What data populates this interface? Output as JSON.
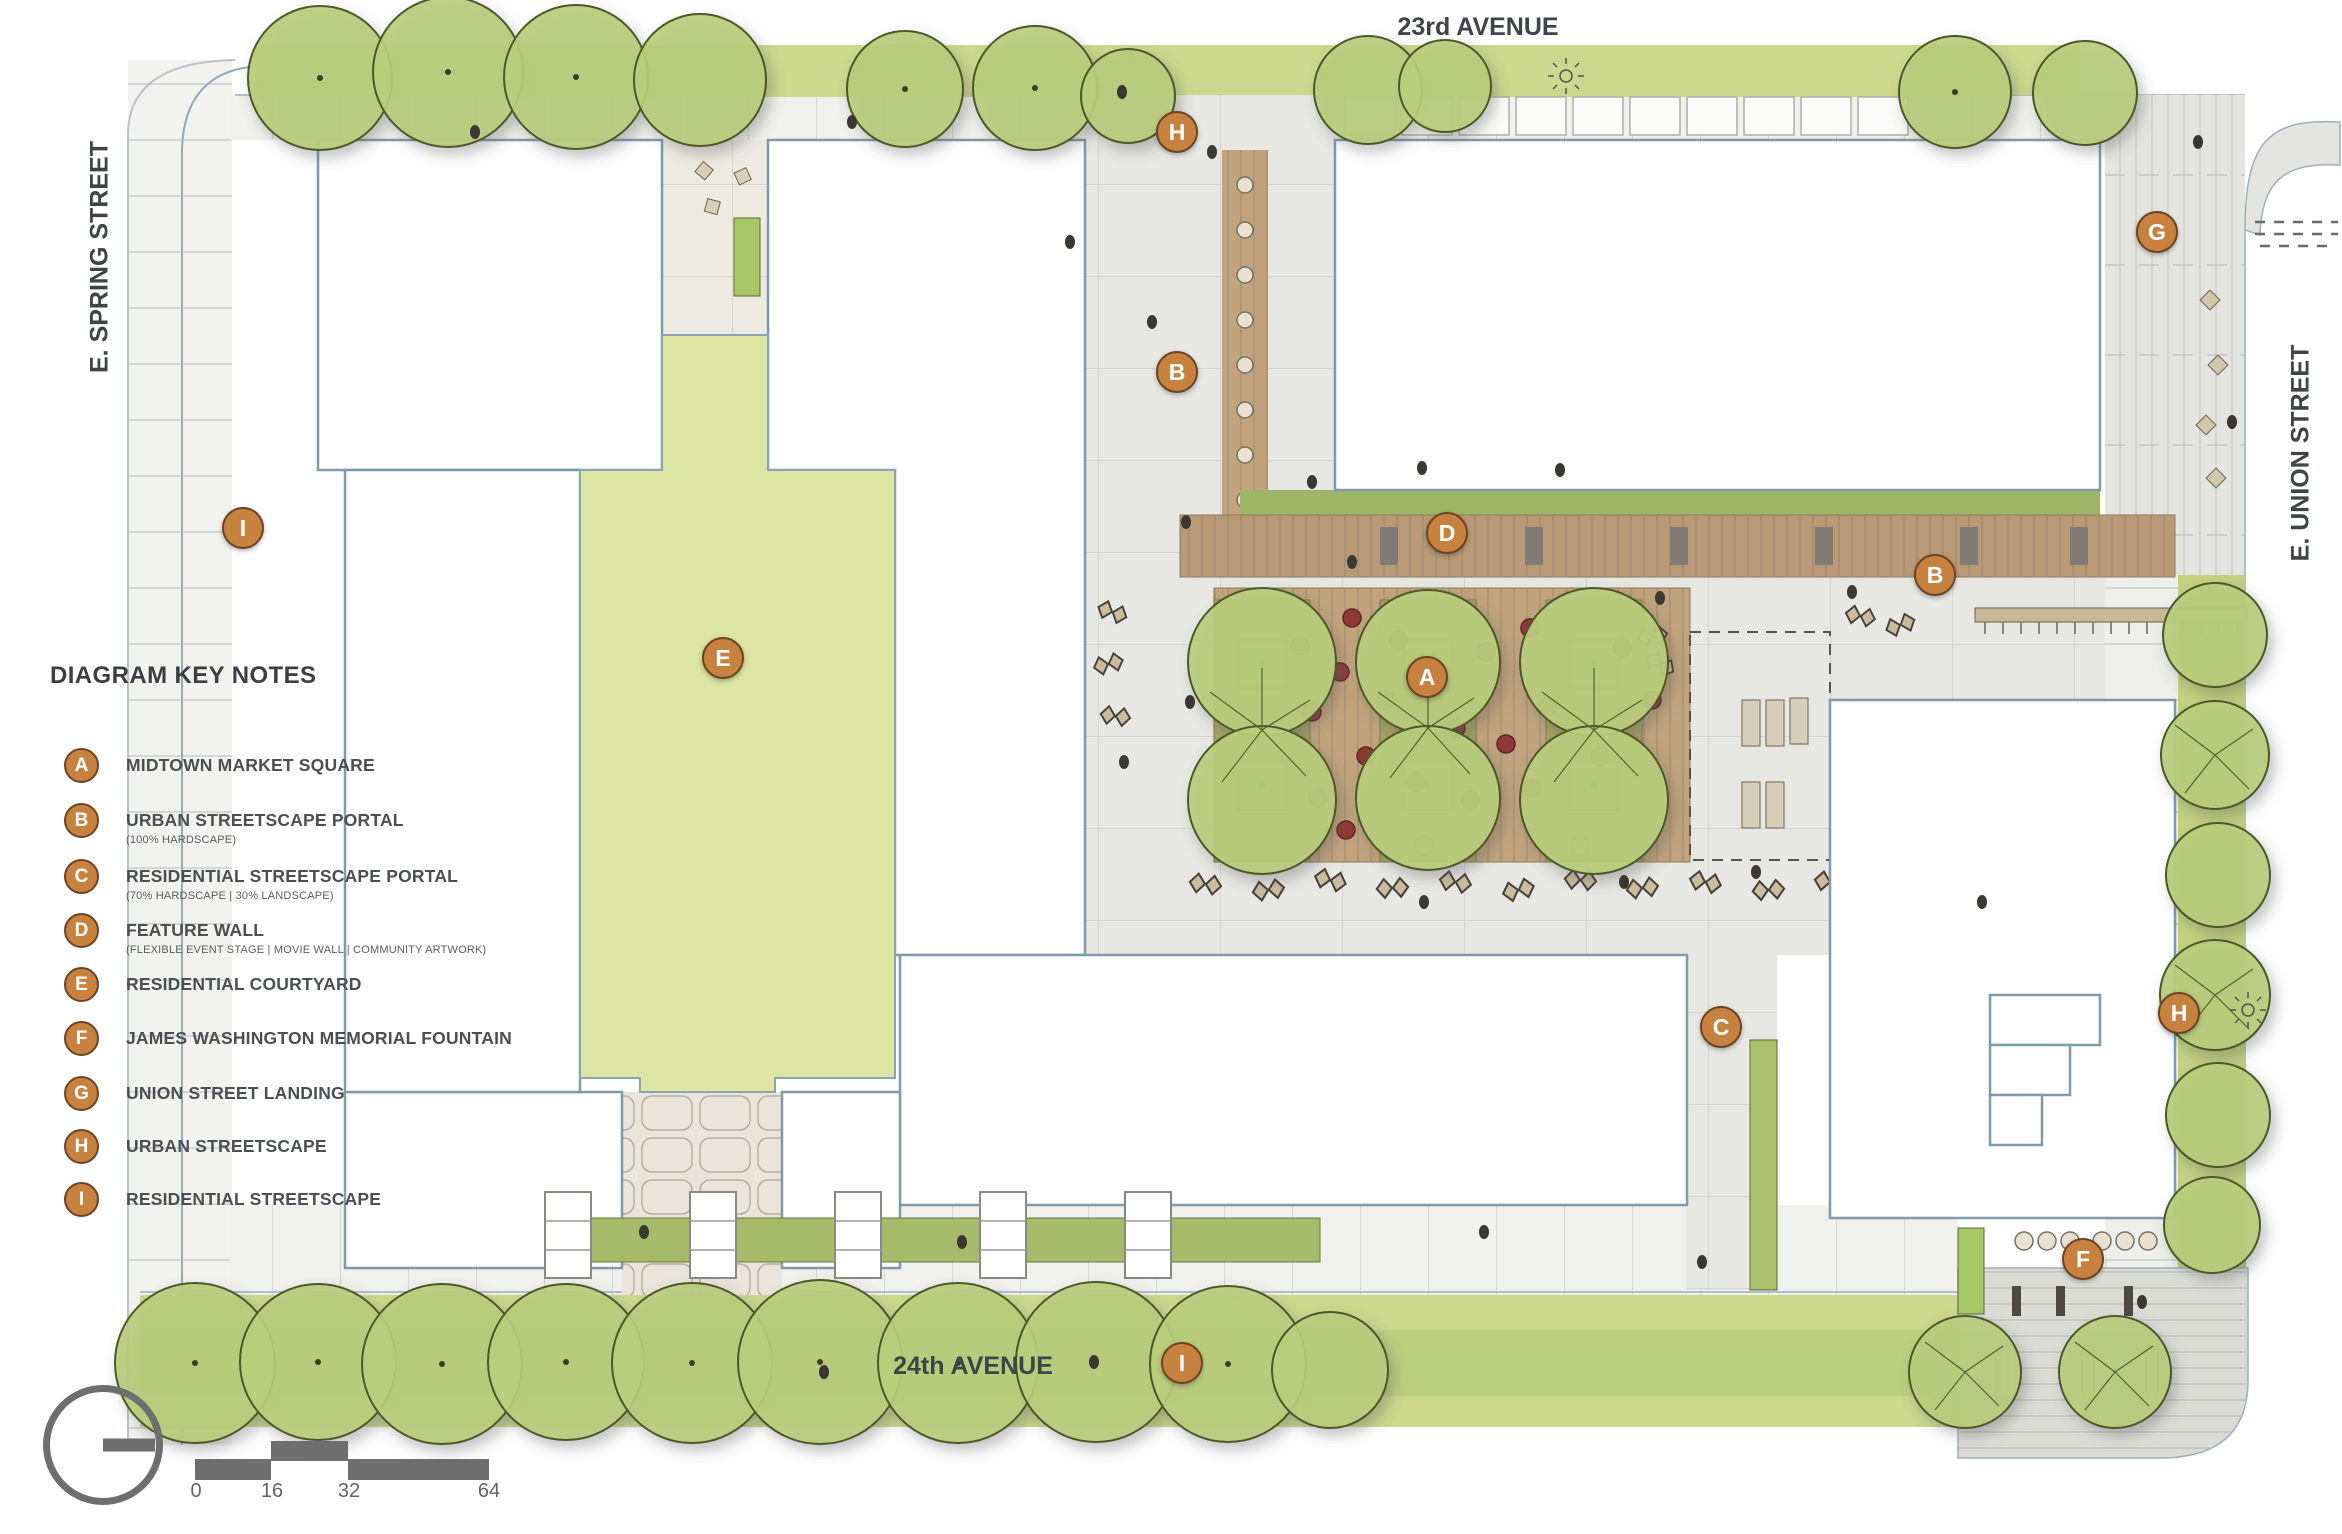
{
  "title": "DIAGRAM KEY NOTES",
  "streets": {
    "top": "23rd AVENUE",
    "bottom": "24th AVENUE",
    "left": "E. SPRING STREET",
    "right": "E. UNION STREET"
  },
  "key_notes": [
    {
      "letter": "A",
      "label": "MIDTOWN MARKET SQUARE",
      "sublabel": ""
    },
    {
      "letter": "B",
      "label": "URBAN STREETSCAPE PORTAL",
      "sublabel": "(100% HARDSCAPE)"
    },
    {
      "letter": "C",
      "label": "RESIDENTIAL STREETSCAPE PORTAL",
      "sublabel": "(70% HARDSCAPE | 30% LANDSCAPE)"
    },
    {
      "letter": "D",
      "label": "FEATURE WALL",
      "sublabel": "(FLEXIBLE EVENT STAGE | MOVIE WALL | COMMUNITY ARTWORK)"
    },
    {
      "letter": "E",
      "label": "RESIDENTIAL COURTYARD",
      "sublabel": ""
    },
    {
      "letter": "F",
      "label": "JAMES WASHINGTON MEMORIAL FOUNTAIN",
      "sublabel": ""
    },
    {
      "letter": "G",
      "label": "UNION STREET LANDING",
      "sublabel": ""
    },
    {
      "letter": "H",
      "label": "URBAN STREETSCAPE",
      "sublabel": ""
    },
    {
      "letter": "I",
      "label": "RESIDENTIAL STREETSCAPE",
      "sublabel": ""
    }
  ],
  "plan_markers": [
    {
      "letter": "H"
    },
    {
      "letter": "G"
    },
    {
      "letter": "B"
    },
    {
      "letter": "D"
    },
    {
      "letter": "B"
    },
    {
      "letter": "A"
    },
    {
      "letter": "I"
    },
    {
      "letter": "E"
    },
    {
      "letter": "C"
    },
    {
      "letter": "H"
    },
    {
      "letter": "F"
    },
    {
      "letter": "I"
    }
  ],
  "scale_bar": {
    "labels": [
      "0",
      "16",
      "32",
      "64"
    ]
  },
  "colors": {
    "accent_orange": "#c8823f",
    "tree_green": "#b9cc7d",
    "lawn_green": "#dce5a1",
    "deck_brown": "#c1a47d",
    "hardscape_gray": "#e7e7e3",
    "ink": "#3f4447"
  }
}
